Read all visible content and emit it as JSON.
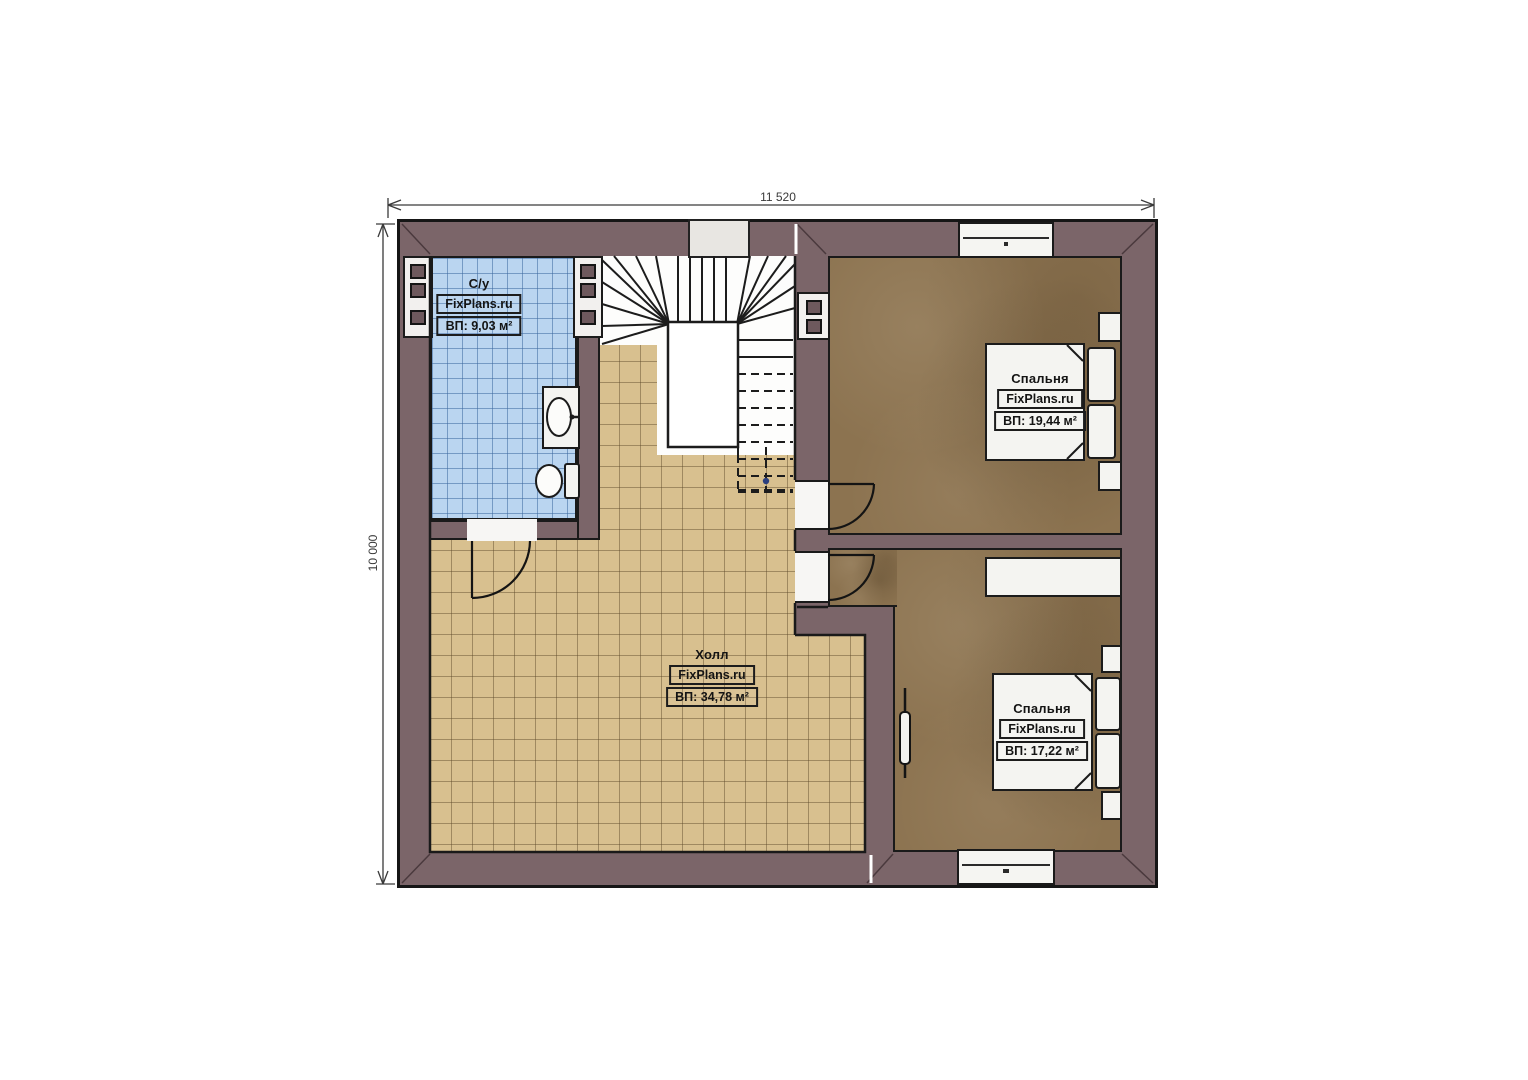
{
  "plan": {
    "dimension_top": "11 520",
    "dimension_left": "10 000",
    "rooms": {
      "bathroom": {
        "name": "С/у",
        "brand": "FixPlans.ru",
        "area": "ВП: 9,03 м²"
      },
      "hall": {
        "name": "Холл",
        "brand": "FixPlans.ru",
        "area": "ВП: 34,78 м²"
      },
      "bedroom1": {
        "name": "Спальня",
        "brand": "FixPlans.ru",
        "area": "ВП: 19,44 м²"
      },
      "bedroom2": {
        "name": "Спальня",
        "brand": "FixPlans.ru",
        "area": "ВП: 17,22 м²"
      }
    },
    "colors": {
      "wall": "#7b6569",
      "bathroom_floor": "#bad5f0",
      "hall_floor": "#d8c08f",
      "bedroom_floor": "#8c7350",
      "outline": "#1a1a1a",
      "fixture_white": "#f4f4f1"
    }
  }
}
